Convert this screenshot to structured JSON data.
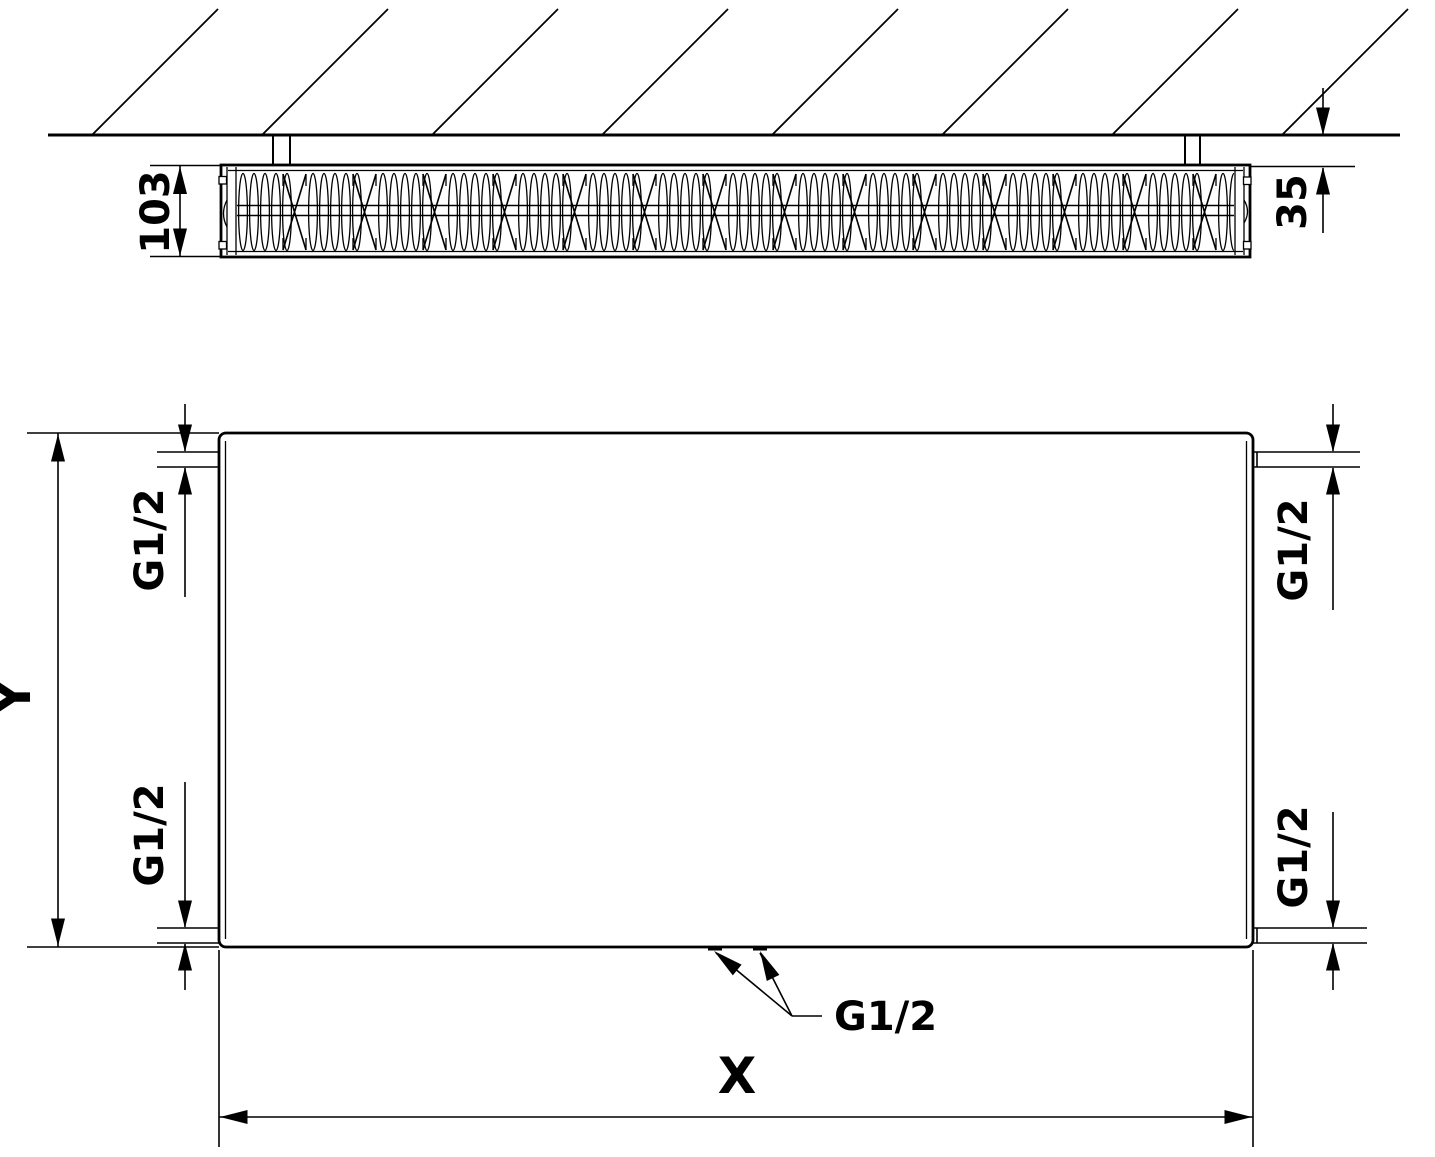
{
  "colors": {
    "line": "#000000",
    "background": "#ffffff"
  },
  "side_view": {
    "depth_label": "103",
    "wall_distance_label": "35"
  },
  "front_view": {
    "height_label": "Y",
    "length_label": "X",
    "connections": {
      "top_left": "G1/2",
      "bottom_left": "G1/2",
      "top_right": "G1/2",
      "bottom_right": "G1/2",
      "bottom_center": "G1/2"
    }
  }
}
